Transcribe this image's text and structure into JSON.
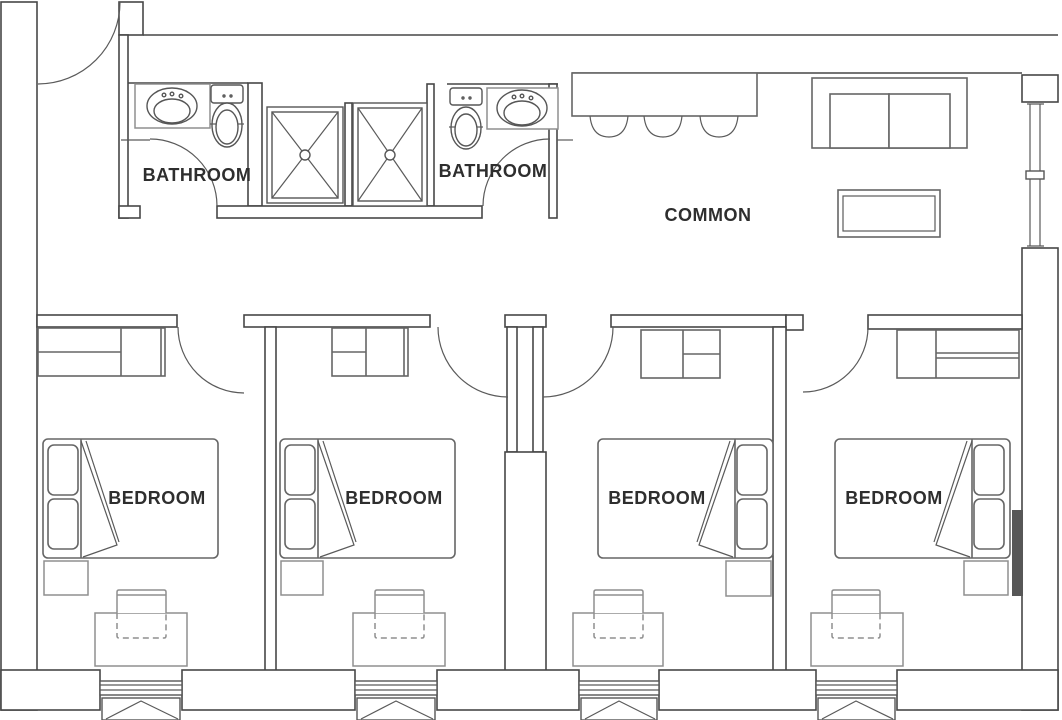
{
  "floorplan": {
    "rooms": [
      {
        "id": "bathroom-1",
        "label": "BATHROOM"
      },
      {
        "id": "bathroom-2",
        "label": "BATHROOM"
      },
      {
        "id": "common",
        "label": "COMMON"
      },
      {
        "id": "bedroom-1",
        "label": "BEDROOM"
      },
      {
        "id": "bedroom-2",
        "label": "BEDROOM"
      },
      {
        "id": "bedroom-3",
        "label": "BEDROOM"
      },
      {
        "id": "bedroom-4",
        "label": "BEDROOM"
      }
    ],
    "colors": {
      "wall": "#474747",
      "furniture": "#666666",
      "light_furniture": "#8f8f8f",
      "text": "#2e2e2e",
      "radiator": "#575757",
      "background": "#ffffff"
    }
  }
}
